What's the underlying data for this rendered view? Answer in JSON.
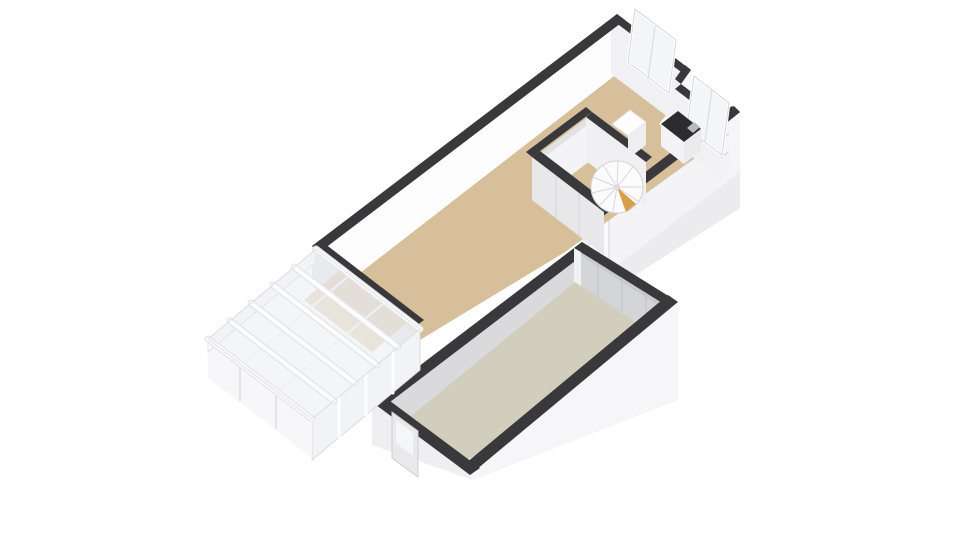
{
  "scene": {
    "width": 960,
    "height": 540,
    "background": "#ffffff",
    "kind": "3d-floorplan-isometric"
  },
  "palette": {
    "wall_top": "#39393c",
    "wall_white": "#fdfdfe",
    "wall_light": "#f1f1f4",
    "wall_shadow": "#e8e8eb",
    "floor_main": "#d6bf9a",
    "floor_garage": "#d1cebd",
    "garage_door": "#c8cacd",
    "glass": "#e2e7ec",
    "counter_dark": "#2c2c2e",
    "stair_wood": "#d79f49"
  },
  "shapes": [
    {
      "name": "main-room-se-wall-face",
      "type": "polygon",
      "points": "740,112 581,233 581,310 740,208",
      "fill": "#f4f4f6"
    },
    {
      "name": "main-room-se-wall-face-shade",
      "type": "polygon",
      "points": "740,172 581,293 581,310 740,208",
      "fill": "#ececef"
    },
    {
      "name": "entry-door",
      "type": "polygon",
      "points": "609,214 589,229 589,284 609,269",
      "fill": "#fafafb",
      "stroke": "#d7d7da",
      "strokeWidth": 1
    },
    {
      "name": "entry-door-seam",
      "type": "line",
      "x1": 599,
      "y1": 222,
      "x2": 599,
      "y2": 277,
      "stroke": "#d7d7da",
      "strokeWidth": 1
    },
    {
      "name": "se-wall-small-window",
      "type": "polygon",
      "points": "734,130 719,141 719,159 734,148",
      "fill": "#f3f5f7",
      "stroke": "#cdd1d4",
      "strokeWidth": 1
    },
    {
      "name": "main-room-floor",
      "type": "polygon",
      "points": "352,272 618,73 669,112 659,124 702,153 565,252 420,340",
      "fill": "#d6bf9a"
    },
    {
      "name": "nw-wall-inner-face",
      "type": "polygon",
      "points": "320,252 618,21 618,73 320,304",
      "fill": "#fdfdfe"
    },
    {
      "name": "window1-wall-inner-face",
      "type": "polygon",
      "points": "611,19 685,75 685,130 611,74",
      "fill": "#f1f1f4"
    },
    {
      "name": "notch-wall-face",
      "type": "polygon",
      "points": "691,70 681,84 681,136 691,122",
      "fill": "#f8f8fa"
    },
    {
      "name": "window2-wall-inner-face",
      "type": "polygon",
      "points": "673,90 721,127 721,179 673,142",
      "fill": "#f1f1f4"
    },
    {
      "name": "east-wall-face",
      "type": "polygon",
      "points": "729,121 740,112 740,163 729,172",
      "fill": "#f6f6f8"
    },
    {
      "name": "sw-wall-exterior-face",
      "type": "polygon",
      "points": "312,246 416,326 416,366 312,286",
      "fill": "#ebebee",
      "opacity": 0.9
    },
    {
      "name": "nw-wall-top",
      "type": "polygon",
      "points": "312,246 617,14 625,20 320,252",
      "fill": "#39393c"
    },
    {
      "name": "window1-wall-top",
      "type": "polygon",
      "points": "617,14 691,70 685,75 611,19",
      "fill": "#39393c"
    },
    {
      "name": "notch-wall-top",
      "type": "polygon",
      "points": "691,70 681,84 675,79 685,65",
      "fill": "#39393c"
    },
    {
      "name": "window2-wall-top",
      "type": "polygon",
      "points": "681,84 729,121 723,126 675,89",
      "fill": "#39393c"
    },
    {
      "name": "east-corner-wall-top",
      "type": "polygon",
      "points": "729,121 740,112 734,106 723,115",
      "fill": "#39393c"
    },
    {
      "name": "se-wall-top",
      "type": "polygon",
      "points": "740,112 581,233 573,227 732,106",
      "fill": "#39393c"
    },
    {
      "name": "sw-wall-top",
      "type": "polygon",
      "points": "312,246 416,326 424,320 320,240",
      "fill": "#39393c"
    },
    {
      "name": "window1-pane",
      "type": "polygon",
      "points": "635,9 676,40 669,93 628,62",
      "fill": "#f3f5f7",
      "stroke": "#ffffff",
      "strokeWidth": 3
    },
    {
      "name": "window1-frame",
      "type": "polygon",
      "points": "635,9 676,40 669,93 628,62",
      "fill": "none",
      "stroke": "#d2d6d9",
      "strokeWidth": 1
    },
    {
      "name": "window1-mullion",
      "type": "line",
      "x1": 655,
      "y1": 27,
      "x2": 648,
      "y2": 79,
      "stroke": "#d5d9dc",
      "strokeWidth": 1
    },
    {
      "name": "window2-pane",
      "type": "polygon",
      "points": "694,76 729,103 722,155 687,128",
      "fill": "#f3f5f7",
      "stroke": "#ffffff",
      "strokeWidth": 3
    },
    {
      "name": "window2-frame",
      "type": "polygon",
      "points": "694,76 729,103 722,155 687,128",
      "fill": "none",
      "stroke": "#d2d6d9",
      "strokeWidth": 1
    },
    {
      "name": "window2-mullion",
      "type": "line",
      "x1": 712,
      "y1": 90,
      "x2": 705,
      "y2": 141,
      "stroke": "#d5d9dc",
      "strokeWidth": 1
    },
    {
      "name": "kitchen-counter-top",
      "type": "polygon",
      "points": "661,124 678,111 701,129 684,142",
      "fill": "#2c2c2e"
    },
    {
      "name": "kitchen-counter-front",
      "type": "polygon",
      "points": "684,142 701,129 701,151 684,164",
      "fill": "#ebebed"
    },
    {
      "name": "kitchen-counter-side",
      "type": "polygon",
      "points": "661,124 684,142 684,164 661,146",
      "fill": "#f3f3f5"
    },
    {
      "name": "kitchen-sink",
      "type": "polygon",
      "points": "687,128 694,122 700,127 693,133",
      "fill": "#b7b9bc"
    },
    {
      "name": "closet-floor",
      "type": "polygon",
      "points": "540,153 588,117 614,137 566,173",
      "fill": "#e2e2e5"
    },
    {
      "name": "closet-nw-wall-face",
      "type": "polygon",
      "points": "538,162 598,117 598,155 538,200",
      "fill": "#f4f4f6"
    },
    {
      "name": "stairwell-ne-wall-face",
      "type": "polygon",
      "points": "586,117 646,162 646,206 586,161",
      "fill": "#f0f0f3"
    },
    {
      "name": "closet-sw-wall-face",
      "type": "polygon",
      "points": "532,157 604,212 604,255 532,200",
      "fill": "#e8e8eb"
    },
    {
      "name": "closet-door-seam-1",
      "type": "line",
      "x1": 556,
      "y1": 176,
      "x2": 556,
      "y2": 219,
      "stroke": "#d6d6d9",
      "strokeWidth": 1
    },
    {
      "name": "closet-door-seam-2",
      "type": "line",
      "x1": 579,
      "y1": 194,
      "x2": 579,
      "y2": 237,
      "stroke": "#d6d6d9",
      "strokeWidth": 1
    },
    {
      "name": "closet-nw-wall-top",
      "type": "polygon",
      "points": "532,157 592,112 586,107 526,152",
      "fill": "#39393c"
    },
    {
      "name": "stairwell-ne-wall-top",
      "type": "polygon",
      "points": "592,112 652,157 646,162 586,117",
      "fill": "#39393c"
    },
    {
      "name": "closet-sw-wall-top",
      "type": "polygon",
      "points": "532,157 604,212 612,206 540,151",
      "fill": "#39393c"
    },
    {
      "name": "stair-cabinet-top",
      "type": "polygon",
      "points": "612,124 630,110 646,122 628,136",
      "fill": "#fdfdfe",
      "stroke": "#e0e0e3",
      "strokeWidth": 1
    },
    {
      "name": "stair-cabinet-front",
      "type": "polygon",
      "points": "628,136 646,122 646,145 628,159",
      "fill": "#eeeef1"
    },
    {
      "name": "spiral-stair-base",
      "type": "circle",
      "cx": 617,
      "cy": 187,
      "r": 26,
      "fill": "#fbfbfc",
      "stroke": "#d3d3d6",
      "strokeWidth": 1
    },
    {
      "name": "spiral-stair-tread-1",
      "type": "line",
      "x1": 617,
      "y1": 187,
      "x2": 643,
      "y2": 187,
      "stroke": "#d8d8db",
      "strokeWidth": 1
    },
    {
      "name": "spiral-stair-tread-2",
      "type": "line",
      "x1": 617,
      "y1": 187,
      "x2": 638,
      "y2": 201,
      "stroke": "#d8d8db",
      "strokeWidth": 1
    },
    {
      "name": "spiral-stair-tread-3",
      "type": "line",
      "x1": 617,
      "y1": 187,
      "x2": 628,
      "y2": 210,
      "stroke": "#d8d8db",
      "strokeWidth": 1
    },
    {
      "name": "spiral-stair-tread-4",
      "type": "line",
      "x1": 617,
      "y1": 187,
      "x2": 613,
      "y2": 212,
      "stroke": "#d8d8db",
      "strokeWidth": 1
    },
    {
      "name": "spiral-stair-tread-5",
      "type": "line",
      "x1": 617,
      "y1": 187,
      "x2": 599,
      "y2": 206,
      "stroke": "#d8d8db",
      "strokeWidth": 1
    },
    {
      "name": "spiral-stair-tread-6",
      "type": "line",
      "x1": 617,
      "y1": 187,
      "x2": 592,
      "y2": 193,
      "stroke": "#d8d8db",
      "strokeWidth": 1
    },
    {
      "name": "spiral-stair-tread-7",
      "type": "line",
      "x1": 617,
      "y1": 187,
      "x2": 593,
      "y2": 177,
      "stroke": "#d8d8db",
      "strokeWidth": 1
    },
    {
      "name": "spiral-stair-tread-8",
      "type": "line",
      "x1": 617,
      "y1": 187,
      "x2": 603,
      "y2": 165,
      "stroke": "#d8d8db",
      "strokeWidth": 1
    },
    {
      "name": "spiral-stair-tread-9",
      "type": "line",
      "x1": 617,
      "y1": 187,
      "x2": 618,
      "y2": 161,
      "stroke": "#d8d8db",
      "strokeWidth": 1
    },
    {
      "name": "spiral-stair-tread-10",
      "type": "line",
      "x1": 617,
      "y1": 187,
      "x2": 633,
      "y2": 167,
      "stroke": "#d8d8db",
      "strokeWidth": 1
    },
    {
      "name": "spiral-stair-wood-step",
      "type": "polygon",
      "points": "617,187 636,204 626,212",
      "fill": "#d79f49"
    },
    {
      "name": "spiral-stair-post",
      "type": "circle",
      "cx": 617,
      "cy": 187,
      "r": 3,
      "fill": "#dcdcdf"
    },
    {
      "name": "garage-nw-wall-top",
      "type": "polygon",
      "points": "372,402 582,242 591,249 381,409",
      "fill": "#39393c"
    },
    {
      "name": "garage-nw-wall-inner-face",
      "type": "polygon",
      "points": "381,409 591,249 591,286 381,446",
      "fill": "#dadadd"
    },
    {
      "name": "garage-ne-wall-top",
      "type": "polygon",
      "points": "582,242 678,302 670,308 574,248",
      "fill": "#39393c"
    },
    {
      "name": "garage-door-face",
      "type": "polygon",
      "points": "574,248 670,308 670,349 574,289",
      "fill": "#c8cacd"
    },
    {
      "name": "garage-door-panel",
      "type": "polygon",
      "points": "580,255 664,309 664,342 580,288",
      "fill": "#d3d5d7"
    },
    {
      "name": "garage-door-seam-1",
      "type": "line",
      "x1": 598,
      "y1": 263,
      "x2": 598,
      "y2": 297,
      "stroke": "#c0c2c5",
      "strokeWidth": 1
    },
    {
      "name": "garage-door-seam-2",
      "type": "line",
      "x1": 622,
      "y1": 278,
      "x2": 622,
      "y2": 312,
      "stroke": "#c0c2c5",
      "strokeWidth": 1
    },
    {
      "name": "garage-door-seam-3",
      "type": "line",
      "x1": 646,
      "y1": 293,
      "x2": 646,
      "y2": 327,
      "stroke": "#c0c2c5",
      "strokeWidth": 1
    },
    {
      "name": "garage-door-frame-strip",
      "type": "polygon",
      "points": "574,248 581,252 581,293 574,289",
      "fill": "#f1f1f3"
    },
    {
      "name": "garage-floor",
      "type": "polygon",
      "points": "575,282 664,341 466,461 411,416",
      "fill": "#d1cebd"
    },
    {
      "name": "garage-se-wall-top",
      "type": "polygon",
      "points": "678,302 470,475 460,468 668,295",
      "fill": "#39393c"
    },
    {
      "name": "garage-se-wall-face",
      "type": "polygon",
      "points": "678,302 470,475 473,480 678,400",
      "fill": "#f6f6f8"
    },
    {
      "name": "garage-sw-wall-top",
      "type": "polygon",
      "points": "470,475 372,402 382,395 480,468",
      "fill": "#39393c"
    },
    {
      "name": "garage-sw-wall-face",
      "type": "polygon",
      "points": "372,402 372,445 473,480 470,475",
      "fill": "#efeff1"
    },
    {
      "name": "garage-side-door",
      "type": "polygon",
      "points": "392,412 418,431 418,477 392,458",
      "fill": "#e9e9eb",
      "stroke": "#cfcfd2",
      "strokeWidth": 1
    },
    {
      "name": "garage-side-door-window",
      "type": "polygon",
      "points": "396,420 413,433 413,456 396,443",
      "fill": "#f4f6f7"
    },
    {
      "name": "veranda-floor-hint",
      "type": "polygon",
      "points": "340,270 408,322 372,352 304,300",
      "fill": "#d6bf9a",
      "opacity": 0.45
    },
    {
      "name": "veranda-se-glazing",
      "type": "polygon",
      "points": "420,329 312,419 312,460 420,370",
      "fill": "#f2f3f5",
      "stroke": "#dcdcdf",
      "strokeWidth": 1
    },
    {
      "name": "veranda-se-mullion-1",
      "type": "line",
      "x1": 393,
      "y1": 352,
      "x2": 393,
      "y2": 393,
      "stroke": "#fdfdfe",
      "strokeWidth": 3
    },
    {
      "name": "veranda-se-mullion-2",
      "type": "line",
      "x1": 366,
      "y1": 374,
      "x2": 366,
      "y2": 415,
      "stroke": "#fdfdfe",
      "strokeWidth": 3
    },
    {
      "name": "veranda-se-mullion-3",
      "type": "line",
      "x1": 339,
      "y1": 396,
      "x2": 339,
      "y2": 437,
      "stroke": "#fdfdfe",
      "strokeWidth": 3
    },
    {
      "name": "veranda-sw-face",
      "type": "polygon",
      "points": "312,419 208,339 208,378 312,458",
      "fill": "#f7f7f9"
    },
    {
      "name": "veranda-post-1",
      "type": "line",
      "x1": 240,
      "y1": 364,
      "x2": 240,
      "y2": 400,
      "stroke": "#e3e3e6",
      "strokeWidth": 2
    },
    {
      "name": "veranda-post-2",
      "type": "line",
      "x1": 276,
      "y1": 392,
      "x2": 276,
      "y2": 428,
      "stroke": "#e3e3e6",
      "strokeWidth": 2
    },
    {
      "name": "veranda-nw-fascia",
      "type": "polygon",
      "points": "208,339 316,249 316,262 208,352",
      "fill": "#fbfbfd",
      "stroke": "#e4e4e7",
      "strokeWidth": 1
    },
    {
      "name": "veranda-roof-glass",
      "type": "polygon",
      "points": "316,249 420,329 312,419 208,339",
      "fill": "#e2e7ec",
      "opacity": 0.42
    },
    {
      "name": "veranda-cross-member-1",
      "type": "line",
      "x1": 242,
      "y1": 365,
      "x2": 350,
      "y2": 275,
      "stroke": "#f0f1f3",
      "strokeWidth": 2
    },
    {
      "name": "veranda-cross-member-2",
      "type": "line",
      "x1": 277,
      "y1": 392,
      "x2": 385,
      "y2": 302,
      "stroke": "#f0f1f3",
      "strokeWidth": 2
    },
    {
      "name": "veranda-beam-1-under",
      "type": "line",
      "x1": 208,
      "y1": 339,
      "x2": 312,
      "y2": 419,
      "stroke": "#e6e7ea",
      "strokeWidth": 7
    },
    {
      "name": "veranda-beam-1",
      "type": "line",
      "x1": 208,
      "y1": 339,
      "x2": 312,
      "y2": 419,
      "stroke": "#fcfcfd",
      "strokeWidth": 4
    },
    {
      "name": "veranda-beam-2-under",
      "type": "line",
      "x1": 230,
      "y1": 321,
      "x2": 334,
      "y2": 401,
      "stroke": "#e6e7ea",
      "strokeWidth": 7
    },
    {
      "name": "veranda-beam-2",
      "type": "line",
      "x1": 230,
      "y1": 321,
      "x2": 334,
      "y2": 401,
      "stroke": "#fcfcfd",
      "strokeWidth": 4
    },
    {
      "name": "veranda-beam-3-under",
      "type": "line",
      "x1": 251,
      "y1": 303,
      "x2": 355,
      "y2": 383,
      "stroke": "#e6e7ea",
      "strokeWidth": 7
    },
    {
      "name": "veranda-beam-3",
      "type": "line",
      "x1": 251,
      "y1": 303,
      "x2": 355,
      "y2": 383,
      "stroke": "#fcfcfd",
      "strokeWidth": 4
    },
    {
      "name": "veranda-beam-4-under",
      "type": "line",
      "x1": 273,
      "y1": 285,
      "x2": 377,
      "y2": 365,
      "stroke": "#e6e7ea",
      "strokeWidth": 7
    },
    {
      "name": "veranda-beam-4",
      "type": "line",
      "x1": 273,
      "y1": 285,
      "x2": 377,
      "y2": 365,
      "stroke": "#fcfcfd",
      "strokeWidth": 4
    },
    {
      "name": "veranda-beam-5-under",
      "type": "line",
      "x1": 294,
      "y1": 267,
      "x2": 398,
      "y2": 347,
      "stroke": "#e6e7ea",
      "strokeWidth": 7
    },
    {
      "name": "veranda-beam-5",
      "type": "line",
      "x1": 294,
      "y1": 267,
      "x2": 398,
      "y2": 347,
      "stroke": "#fcfcfd",
      "strokeWidth": 4
    },
    {
      "name": "veranda-beam-6-under",
      "type": "line",
      "x1": 316,
      "y1": 249,
      "x2": 420,
      "y2": 329,
      "stroke": "#e6e7ea",
      "strokeWidth": 7
    },
    {
      "name": "veranda-beam-6",
      "type": "line",
      "x1": 316,
      "y1": 249,
      "x2": 420,
      "y2": 329,
      "stroke": "#fcfcfd",
      "strokeWidth": 4
    },
    {
      "name": "veranda-roof-outline",
      "type": "polygon",
      "points": "316,249 420,329 312,419 208,339",
      "fill": "none",
      "stroke": "#e0e0e3",
      "strokeWidth": 1
    }
  ]
}
